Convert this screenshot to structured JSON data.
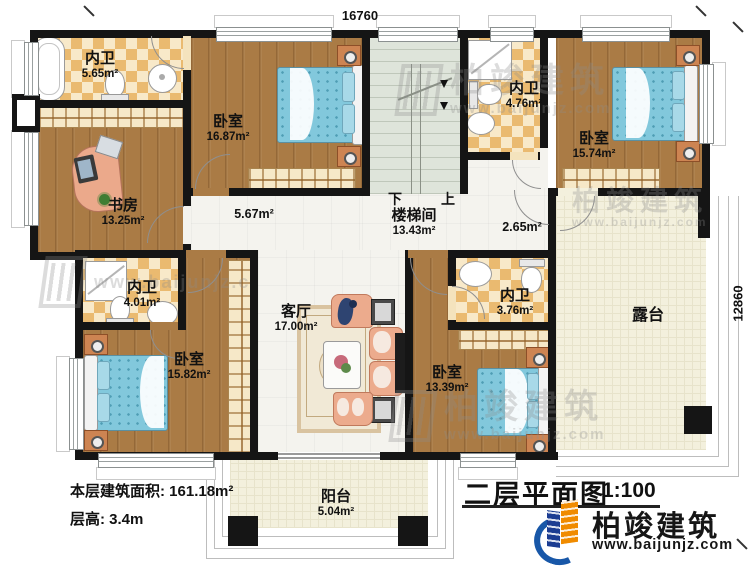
{
  "dimensions": {
    "top": "16760",
    "right": "12860"
  },
  "rooms": [
    {
      "id": "bath-ensuite-1",
      "name": "内卫",
      "area": "5.65m²"
    },
    {
      "id": "study",
      "name": "书房",
      "area": "13.25m²"
    },
    {
      "id": "bedroom-1",
      "name": "卧室",
      "area": "16.87m²"
    },
    {
      "id": "hallway-1",
      "name": "",
      "area": "5.67m²"
    },
    {
      "id": "stairwell",
      "name": "楼梯间",
      "area": "13.43m²"
    },
    {
      "id": "bath-ensuite-2",
      "name": "内卫",
      "area": "4.76m²"
    },
    {
      "id": "bedroom-2",
      "name": "卧室",
      "area": "15.74m²"
    },
    {
      "id": "hallway-2",
      "name": "",
      "area": "2.65m²"
    },
    {
      "id": "bath-ensuite-3",
      "name": "内卫",
      "area": "4.01m²"
    },
    {
      "id": "bedroom-3",
      "name": "卧室",
      "area": "15.82m²"
    },
    {
      "id": "living-room",
      "name": "客厅",
      "area": "17.00m²"
    },
    {
      "id": "bath-ensuite-4",
      "name": "内卫",
      "area": "3.76m²"
    },
    {
      "id": "bedroom-4",
      "name": "卧室",
      "area": "13.39m²"
    },
    {
      "id": "terrace",
      "name": "露台",
      "area": ""
    },
    {
      "id": "balcony",
      "name": "阳台",
      "area": "5.04m²"
    }
  ],
  "stairs": {
    "down": "下",
    "up": "上"
  },
  "info": {
    "floor_area_label": "本层建筑面积:",
    "floor_area_value": "161.18m²",
    "height_label": "层高:",
    "height_value": "3.4m"
  },
  "title_block": {
    "title": "二层平面图",
    "scale": "1:100"
  },
  "brand": {
    "name": "柏竣建筑",
    "website": "www.baijunjz.com"
  },
  "watermark": {
    "name": "柏竣建筑",
    "website": "www.baijunjz.com",
    "website_short": "www.baijunjz.c"
  }
}
